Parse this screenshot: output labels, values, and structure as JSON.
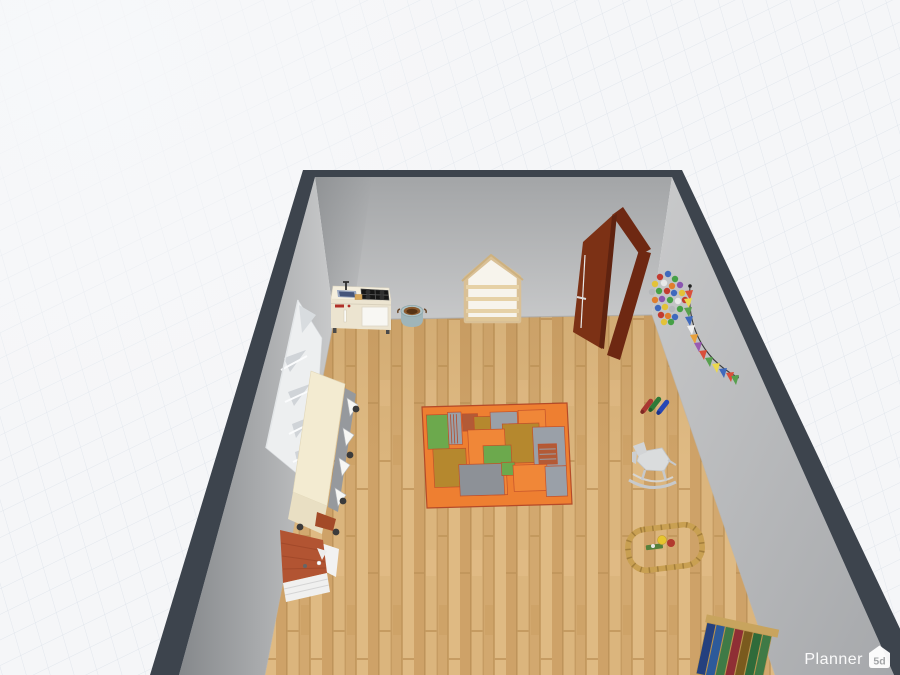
{
  "app": {
    "watermark": {
      "brand": "Planner",
      "logo_text": "5d"
    }
  },
  "scene": {
    "description": "3D perspective view of a kids playroom inside a floor-planner canvas with perspective grid",
    "palette": {
      "canvas_bg": "#f5f6f8",
      "grid_line": "#dce2ea",
      "wall_edge": "#3d444d",
      "wall_face_light": "#cbcccd",
      "wall_face_dark": "#87898c",
      "floor_wood": "#d5ac73",
      "door_brown": "#7c3115",
      "kitchen_cream": "#ece4d0",
      "shelf_wood": "#d9c096",
      "rug_orange": "#ee7f31",
      "rug_green": "#6ca94d",
      "rug_gray": "#9aa0a8",
      "rug_ochre": "#b5882e",
      "rug_rust": "#b35a36",
      "track_tan": "#c9a052",
      "storage_cream": "#f3ebd1",
      "dollhouse_roof": "#b25432"
    },
    "objects": [
      {
        "id": "play-kitchen",
        "label": "toy kitchen",
        "color": "#ece4d0"
      },
      {
        "id": "basket",
        "label": "basket with toys",
        "color": "#9fb5b9"
      },
      {
        "id": "house-shelf",
        "label": "house-shaped shelf",
        "color": "#d9c096"
      },
      {
        "id": "door",
        "label": "open wooden door",
        "color": "#7c3115"
      },
      {
        "id": "flower-decor",
        "label": "flower wall decoration",
        "colors": [
          "#c23b30",
          "#3f69bd",
          "#46a046",
          "#e3c238",
          "#e07f2e",
          "#8a56b0"
        ]
      },
      {
        "id": "flag-garland",
        "label": "triangle flag garland",
        "colors": [
          "#d94f3a",
          "#ecd84e",
          "#58a04e",
          "#3f69bd",
          "#f0f0f0",
          "#e8a13c",
          "#9a5ab0"
        ]
      },
      {
        "id": "cubby-shelf",
        "label": "white cubby wall shelf",
        "color": "#edeff0"
      },
      {
        "id": "storage-unit",
        "label": "toy storage unit on wheels",
        "color": "#f3ebd1"
      },
      {
        "id": "dollhouse",
        "label": "dollhouse",
        "colors": [
          "#b25432",
          "#f0f0ef"
        ]
      },
      {
        "id": "patchwork-rug",
        "label": "patchwork play rug",
        "colors": [
          "#ee7f31",
          "#6ca94d",
          "#9aa0a8",
          "#b5882e",
          "#b35a36"
        ]
      },
      {
        "id": "bowling-pins",
        "label": "toy bowling pins",
        "colors": [
          "#a93832",
          "#2f7a38",
          "#2847b5"
        ]
      },
      {
        "id": "rocking-toy",
        "label": "rocking animal toy",
        "color": "#dadcdd"
      },
      {
        "id": "train-track",
        "label": "wooden train track with train",
        "colors": [
          "#c9a052",
          "#e6c52f",
          "#b23a2e",
          "#55803c"
        ]
      },
      {
        "id": "book-row",
        "label": "row of books",
        "colors": [
          "#24407e",
          "#2d5a9a",
          "#3f7a46",
          "#8f2f35",
          "#7a5a1e",
          "#2f6b3a"
        ]
      }
    ]
  }
}
